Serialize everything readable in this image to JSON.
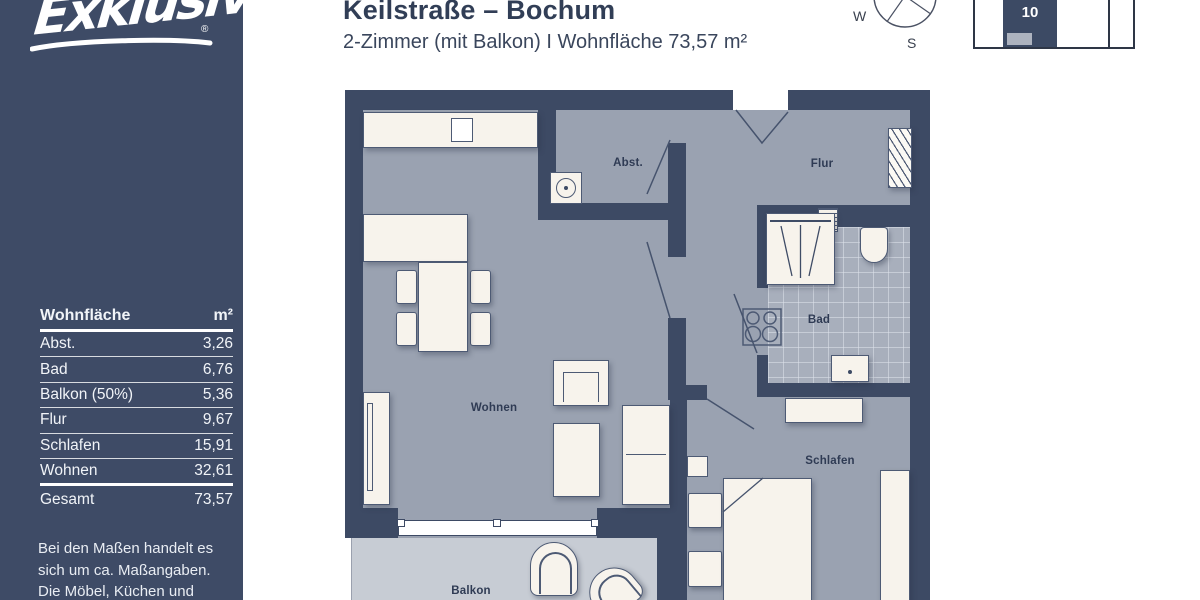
{
  "header": {
    "title": "Keilstraße – Bochum",
    "subtitle": "2-Zimmer (mit Balkon) I Wohnfläche 73,57 m²"
  },
  "brand": {
    "logo_text": "Exklusiv",
    "registered_mark": "®"
  },
  "compass": {
    "west": "W",
    "south": "S"
  },
  "position_indicator": {
    "unit_number": "10"
  },
  "area_table": {
    "title": "Wohnfläche",
    "unit": "m²",
    "rows": [
      {
        "label": "Abst.",
        "value": "3,26"
      },
      {
        "label": "Bad",
        "value": "6,76"
      },
      {
        "label": "Balkon (50%)",
        "value": "5,36"
      },
      {
        "label": "Flur",
        "value": "9,67"
      },
      {
        "label": "Schlafen",
        "value": "15,91"
      },
      {
        "label": "Wohnen",
        "value": "32,61"
      }
    ],
    "total_label": "Gesamt",
    "total_value": "73,57"
  },
  "disclaimer": {
    "lines": [
      "Bei den Maßen handelt es",
      "sich um ca. Maßangaben.",
      "Die Möbel, Küchen und",
      "Sanitärobjekte sind"
    ]
  },
  "floorplan": {
    "labels": {
      "abst": "Abst.",
      "flur": "Flur",
      "bad": "Bad",
      "wohnen": "Wohnen",
      "schlafen": "Schlafen",
      "balkon": "Balkon"
    }
  },
  "colors": {
    "navy": "#3d4a64",
    "sidebar": "#3e4b66",
    "floor": "#9aa2b1",
    "floor_tiles": "#a8afbc",
    "balcony": "#c7ccd4",
    "furniture": "#f7f3ec",
    "title_text": "#313e56"
  }
}
